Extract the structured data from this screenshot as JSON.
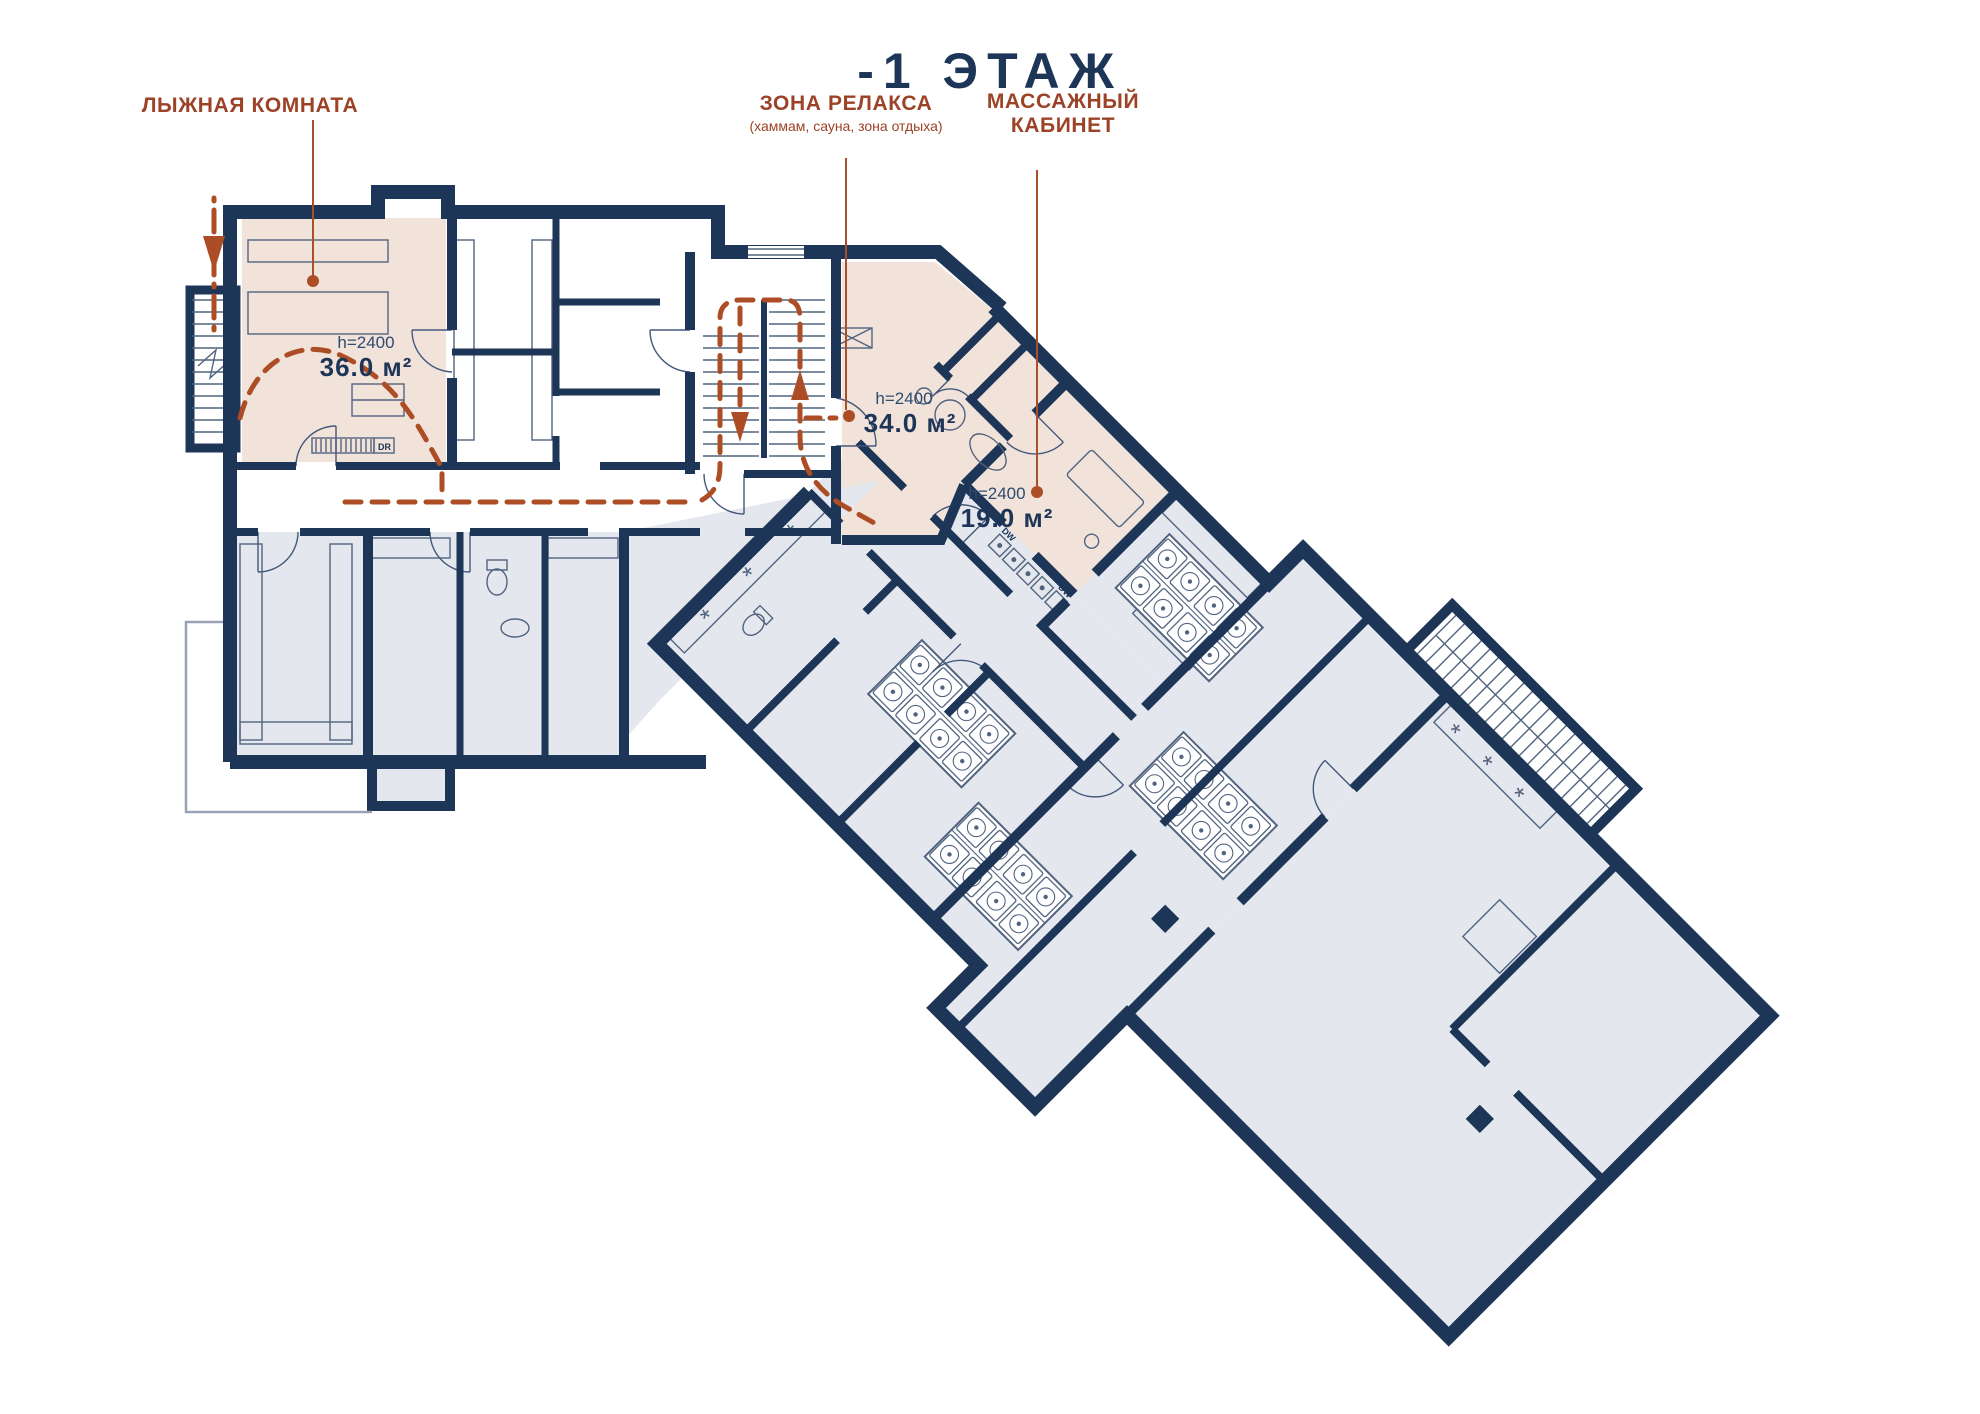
{
  "title": "-1 ЭТАЖ",
  "colors": {
    "wall_navy": "#1d3557",
    "room_gray": "#e4e7ee",
    "highlight_pink": "#f2e3da",
    "accent_rust": "#9c4226",
    "route_rust": "#ad4d26",
    "detail_line": "#51647f"
  },
  "rooms": {
    "ski": {
      "label": "ЛЫЖНАЯ КОМНАТА",
      "ceiling_height": "h=2400",
      "area": "36.0 м²"
    },
    "relax": {
      "label": "ЗОНА РЕЛАКСА",
      "sublabel": "(хаммам, сауна, зона отдыха)",
      "ceiling_height": "h=2400",
      "area": "34.0 м²"
    },
    "massage": {
      "label_line1": "МАССАЖНЫЙ",
      "label_line2": "КАБИНЕТ",
      "ceiling_height": "h=2400",
      "area": "19.0 м²"
    }
  },
  "appliances": {
    "dryer": "DR",
    "dishwasher": "DW",
    "locker": "M"
  }
}
